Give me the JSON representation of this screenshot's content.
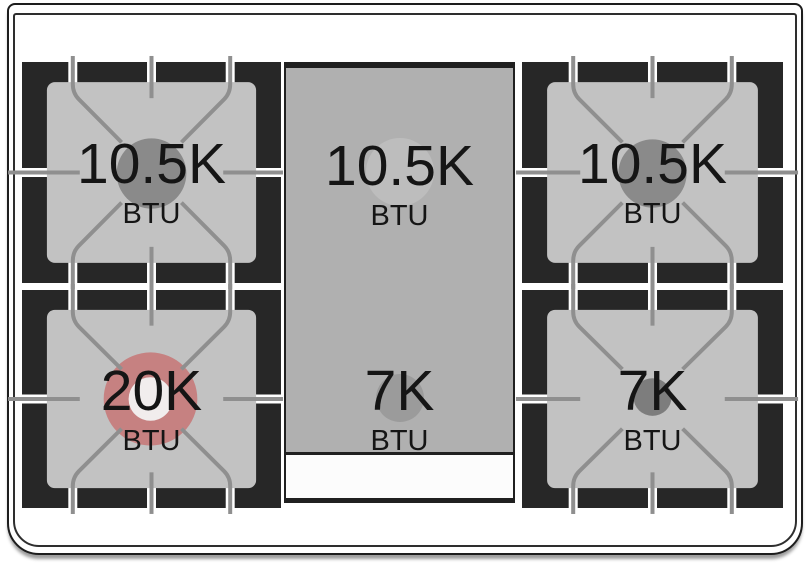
{
  "burners": {
    "top_left": {
      "value": "10.5K",
      "unit": "BTU",
      "circle_color": "#8a8a8a"
    },
    "center_top": {
      "value": "10.5K",
      "unit": "BTU",
      "circle_color": "#bdbdbd"
    },
    "top_right": {
      "value": "10.5K",
      "unit": "BTU",
      "circle_color": "#8a8a8a"
    },
    "bottom_left": {
      "value": "20K",
      "unit": "BTU",
      "circle_color": "#c68181",
      "ring_hole_color": "#f1eded"
    },
    "center_bottom": {
      "value": "7K",
      "unit": "BTU",
      "circle_color": "#9b9b9b"
    },
    "bottom_right": {
      "value": "7K",
      "unit": "BTU",
      "circle_color": "#7d7d7d"
    }
  },
  "palette": {
    "grate_black": "#272727",
    "burner_pad_gray": "#c2c2c2",
    "griddle_panel_gray": "#b0b0b0",
    "grate_line_gray": "#8f8f8f",
    "highlight_red": "#c68181",
    "text_black": "#151515"
  }
}
